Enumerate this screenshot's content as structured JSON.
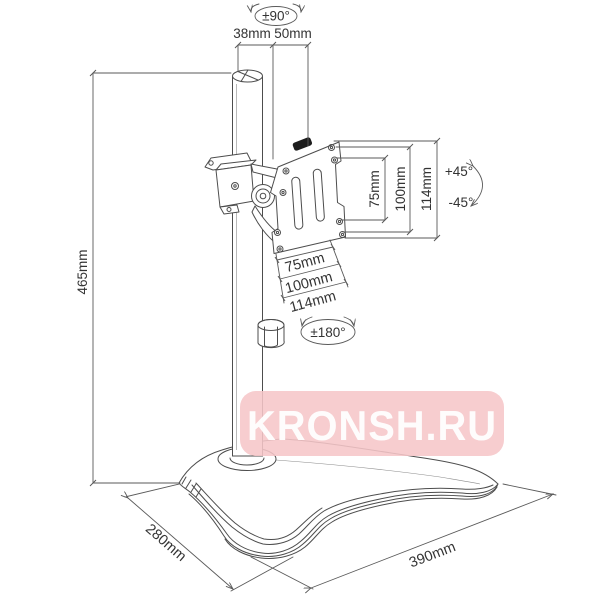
{
  "figure": {
    "type": "technical-drawing",
    "subject": "Desktop monitor stand with VESA mounting plate",
    "line_color": "#4d4d4d",
    "background": "#ffffff"
  },
  "dimensions": {
    "pole": {
      "height": "465mm",
      "diameter": "38mm",
      "offset": "50mm"
    },
    "rotations": {
      "swivel_top": "±90°",
      "tilt_up": "+45°",
      "tilt_down": "-45°",
      "pan": "±180°"
    },
    "vesa": {
      "vertical": [
        "75mm",
        "100mm",
        "114mm"
      ],
      "horizontal": [
        "75mm",
        "100mm",
        "114mm"
      ]
    },
    "base": {
      "depth": "280mm",
      "width": "390mm"
    }
  },
  "watermark": {
    "text": "KRONSH.RU",
    "bg_color": "#f6c6c8",
    "text_color": "#ffffff"
  }
}
